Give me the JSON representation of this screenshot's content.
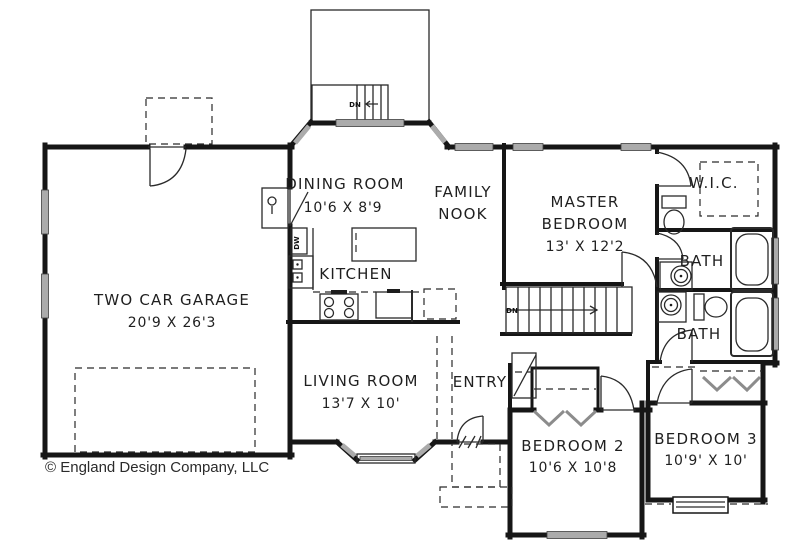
{
  "plan": {
    "rooms": {
      "garage": {
        "name": "TWO CAR GARAGE",
        "dims": "20'9 X 26'3"
      },
      "dining": {
        "name": "DINING ROOM",
        "dims": "10'6 X 8'9"
      },
      "family_nook": {
        "line1": "FAMILY",
        "line2": "NOOK"
      },
      "kitchen": {
        "name": "KITCHEN"
      },
      "master_bedroom": {
        "line1": "MASTER",
        "line2": "BEDROOM",
        "dims": "13' X 12'2"
      },
      "wic": {
        "name": "W.I.C."
      },
      "master_bath": {
        "name": "BATH"
      },
      "hall_bath": {
        "name": "BATH"
      },
      "living": {
        "name": "LIVING ROOM",
        "dims": "13'7 X 10'"
      },
      "entry": {
        "name": "ENTRY"
      },
      "bedroom2": {
        "name": "BEDROOM 2",
        "dims": "10'6 X 10'8"
      },
      "bedroom3": {
        "name": "BEDROOM 3",
        "dims": "10'9' X 10'"
      }
    },
    "annotations": {
      "deck_down": "DN",
      "stairs_down": "DN",
      "dishwasher": "DW"
    },
    "footer": {
      "copyright": "© England Design Company, LLC"
    },
    "colors": {
      "wall": "#161616",
      "window": "#ababab",
      "text": "#1f1f1f",
      "background": "#ffffff"
    }
  }
}
